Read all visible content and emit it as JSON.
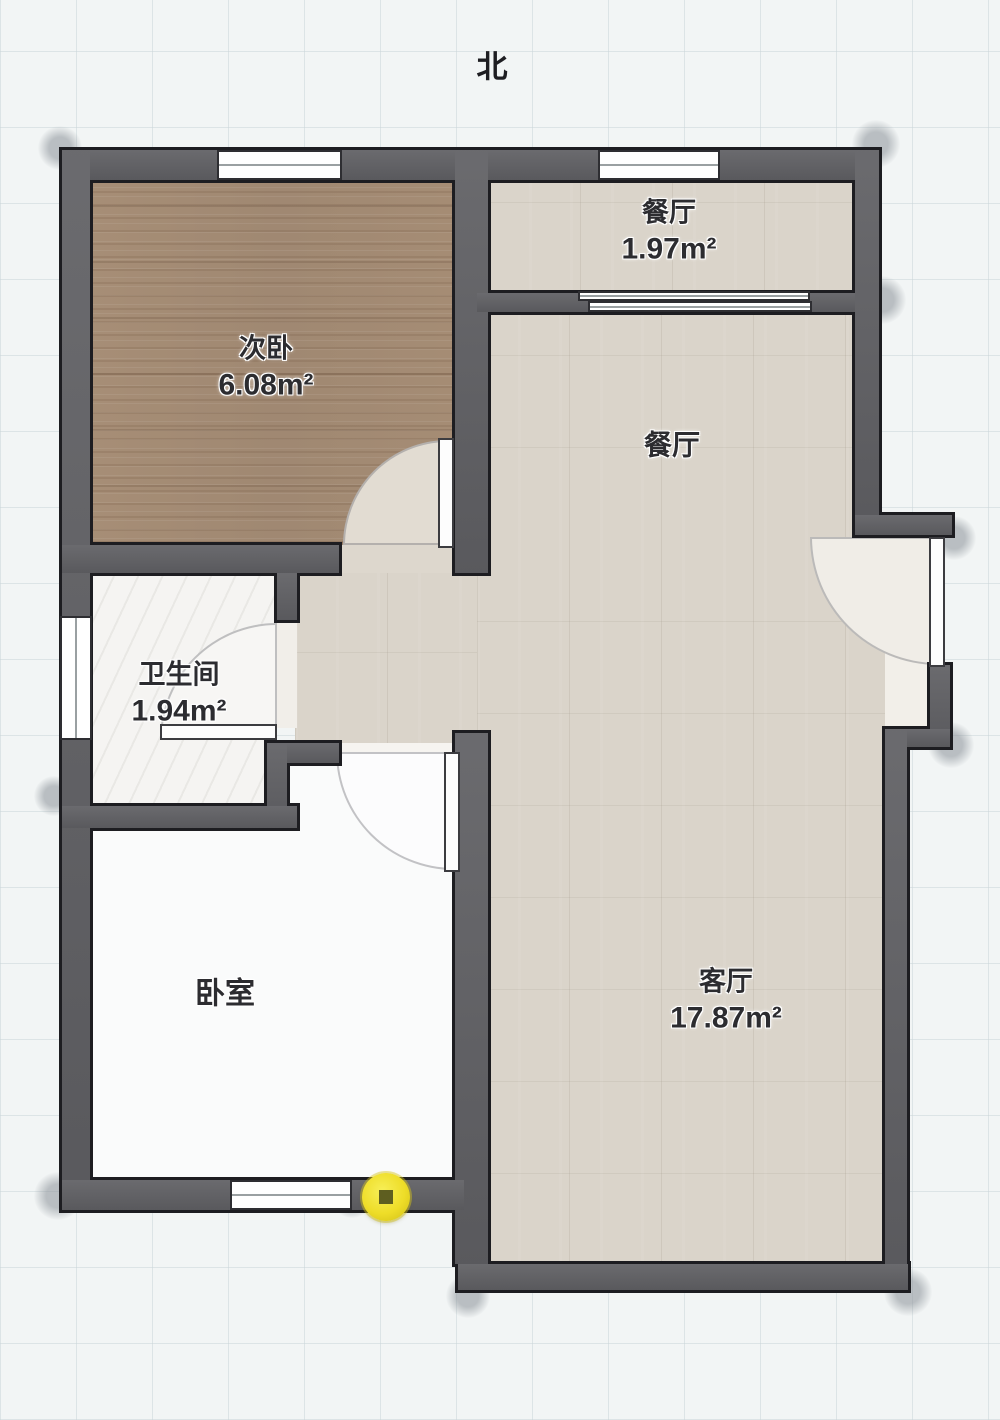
{
  "compass": {
    "label": "北"
  },
  "rooms": [
    {
      "id": "secondary-bedroom",
      "name": "次卧",
      "area": "6.08m²"
    },
    {
      "id": "dining-nook",
      "name": "餐厅",
      "area": "1.97m²"
    },
    {
      "id": "dining",
      "name": "餐厅",
      "area": ""
    },
    {
      "id": "bathroom",
      "name": "卫生间",
      "area": "1.94m²"
    },
    {
      "id": "bedroom",
      "name": "卧室",
      "area": ""
    },
    {
      "id": "living-room",
      "name": "客厅",
      "area": "17.87m²"
    }
  ],
  "marker": {
    "kind": "wall-joint-handle",
    "color": "#eedd28"
  },
  "colors": {
    "background": "#f2f5f5",
    "wall": "#5e5e62",
    "wall_outline": "#1d1d21",
    "wood_floor": "#ab937c",
    "tile_floor": "#dad4ca",
    "bathroom_floor": "#f5f4f2",
    "bedroom_floor": "#fafbfb",
    "marker_yellow": "#eedd28"
  }
}
